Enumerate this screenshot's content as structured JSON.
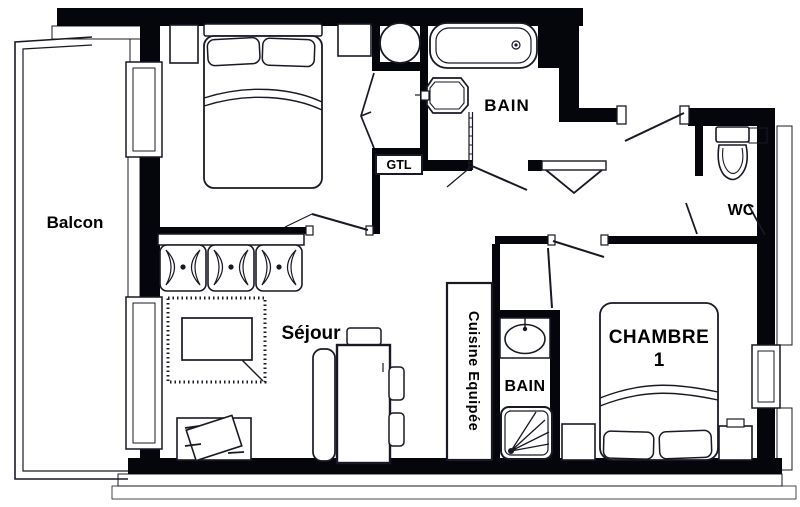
{
  "document_type": "apartment floor plan",
  "colors": {
    "paper": "#ffffff",
    "ink": "#191926",
    "wall": "#05050c",
    "label": "#000000"
  },
  "labels": {
    "balcony": "Balcon",
    "bathroom_top": "BAIN",
    "technical_duct": "GTL",
    "wc": "WC",
    "living_room": "Séjour",
    "kitchen": "Cuisine Equipée",
    "bathroom_bedroom": "BAIN",
    "bedroom1_line1": "CHAMBRE",
    "bedroom1_line2": "1"
  }
}
